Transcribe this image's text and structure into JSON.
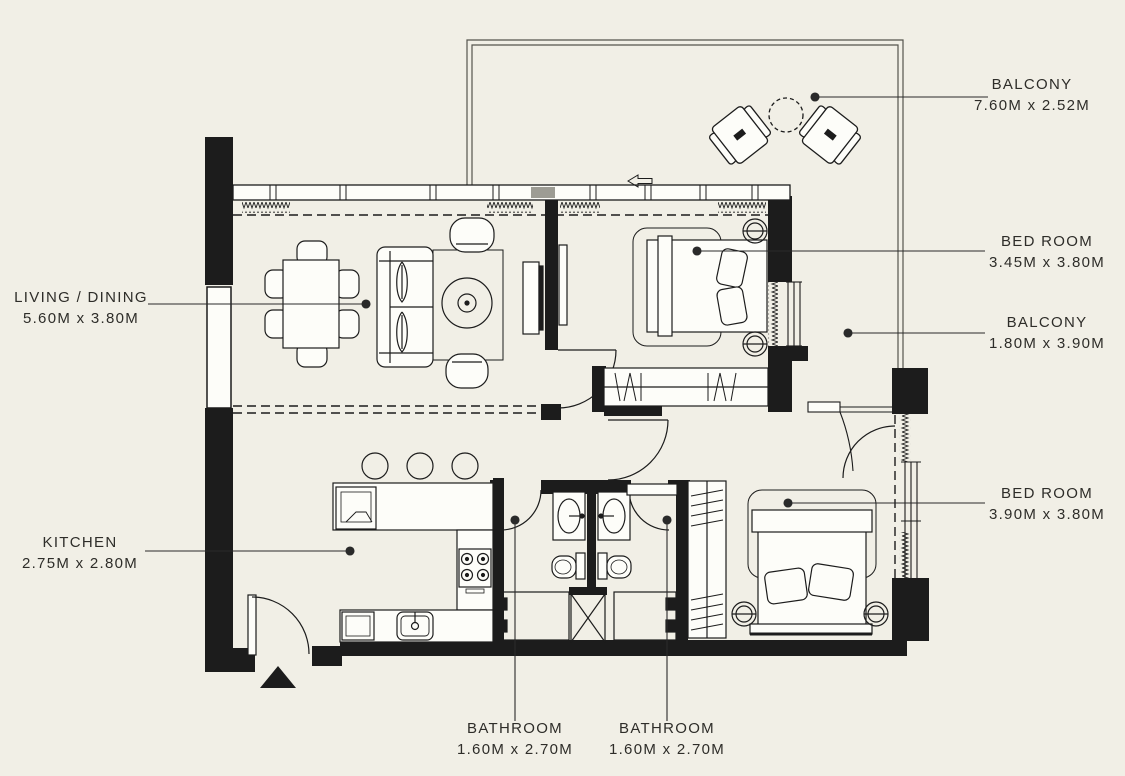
{
  "canvas": {
    "background": "#f1efe6",
    "ink": "#1c1c1c",
    "leader_line": "#2a2a2a"
  },
  "floorplan": {
    "labels": [
      {
        "id": "balcony-top",
        "room": "BALCONY",
        "dims": "7.60M x 2.52M"
      },
      {
        "id": "bedroom-1",
        "room": "BED ROOM",
        "dims": "3.45M x 3.80M"
      },
      {
        "id": "balcony-right",
        "room": "BALCONY",
        "dims": "1.80M x 3.90M"
      },
      {
        "id": "bedroom-2",
        "room": "BED ROOM",
        "dims": "3.90M x 3.80M"
      },
      {
        "id": "living-dining",
        "room": "LIVING / DINING",
        "dims": "5.60M x 3.80M"
      },
      {
        "id": "kitchen",
        "room": "KITCHEN",
        "dims": "2.75M x 2.80M"
      },
      {
        "id": "bathroom-1",
        "room": "BATHROOM",
        "dims": "1.60M x 2.70M"
      },
      {
        "id": "bathroom-2",
        "room": "BATHROOM",
        "dims": "1.60M x 2.70M"
      }
    ]
  }
}
